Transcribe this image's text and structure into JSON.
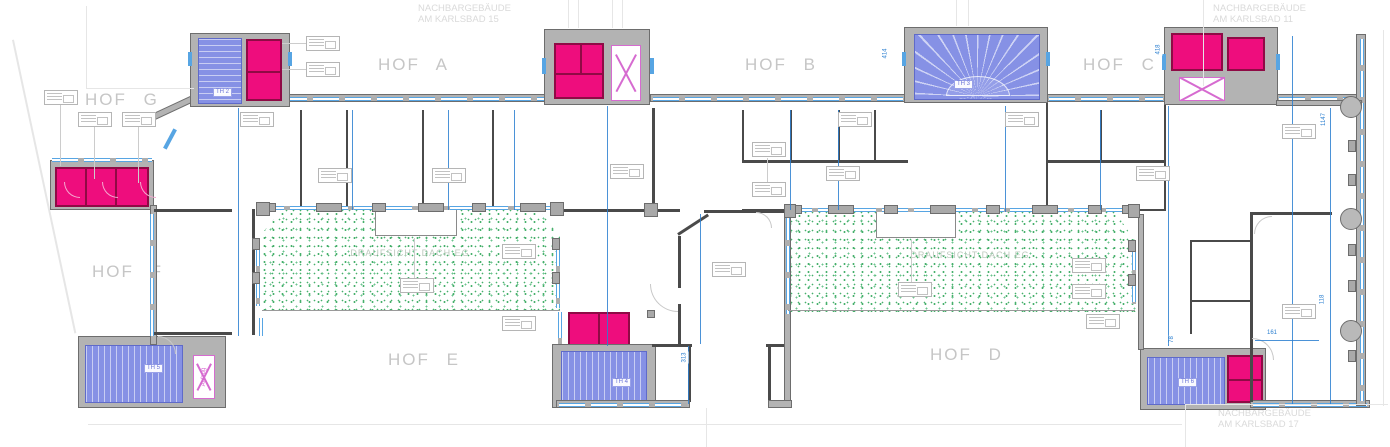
{
  "neighbors": [
    {
      "line1": "NACHBARGEBÄUDE",
      "line2": "AM KARLSBAD 15"
    },
    {
      "line1": "NACHBARGEBÄUDE",
      "line2": "AM KARLSBAD 11"
    },
    {
      "line1": "NACHBARGEBÄUDE",
      "line2": "AM KARLSBAD 17"
    }
  ],
  "hofs": [
    {
      "label": "HOF A"
    },
    {
      "label": "HOF B"
    },
    {
      "label": "HOF C"
    },
    {
      "label": "HOF D"
    },
    {
      "label": "HOF E"
    },
    {
      "label": "HOF F"
    },
    {
      "label": "HOF G"
    }
  ],
  "stairs": [
    {
      "label": "TH 2"
    },
    {
      "label": "TH 3"
    },
    {
      "label": "TH 5"
    },
    {
      "label": "TH 4"
    },
    {
      "label": "TH 6"
    }
  ],
  "overlay_text": "DRAUFSICHT DACH EG",
  "lift_label": "Aufzug",
  "dims": [
    "414",
    "418",
    "313",
    "78",
    "161",
    "1147",
    "118"
  ],
  "colors": {
    "wall_fill": "#b3b3b3",
    "wall_line": "#4a4a4a",
    "window_blue": "#57a5e3",
    "dimension_blue": "#2b7fd0",
    "stair_blue": "#8691e5",
    "room_magenta": "#ee0d7d",
    "lift_magenta": "#d66bd0",
    "courtyard_green": "#47b06c",
    "label_gray": "#c6c6c6"
  }
}
